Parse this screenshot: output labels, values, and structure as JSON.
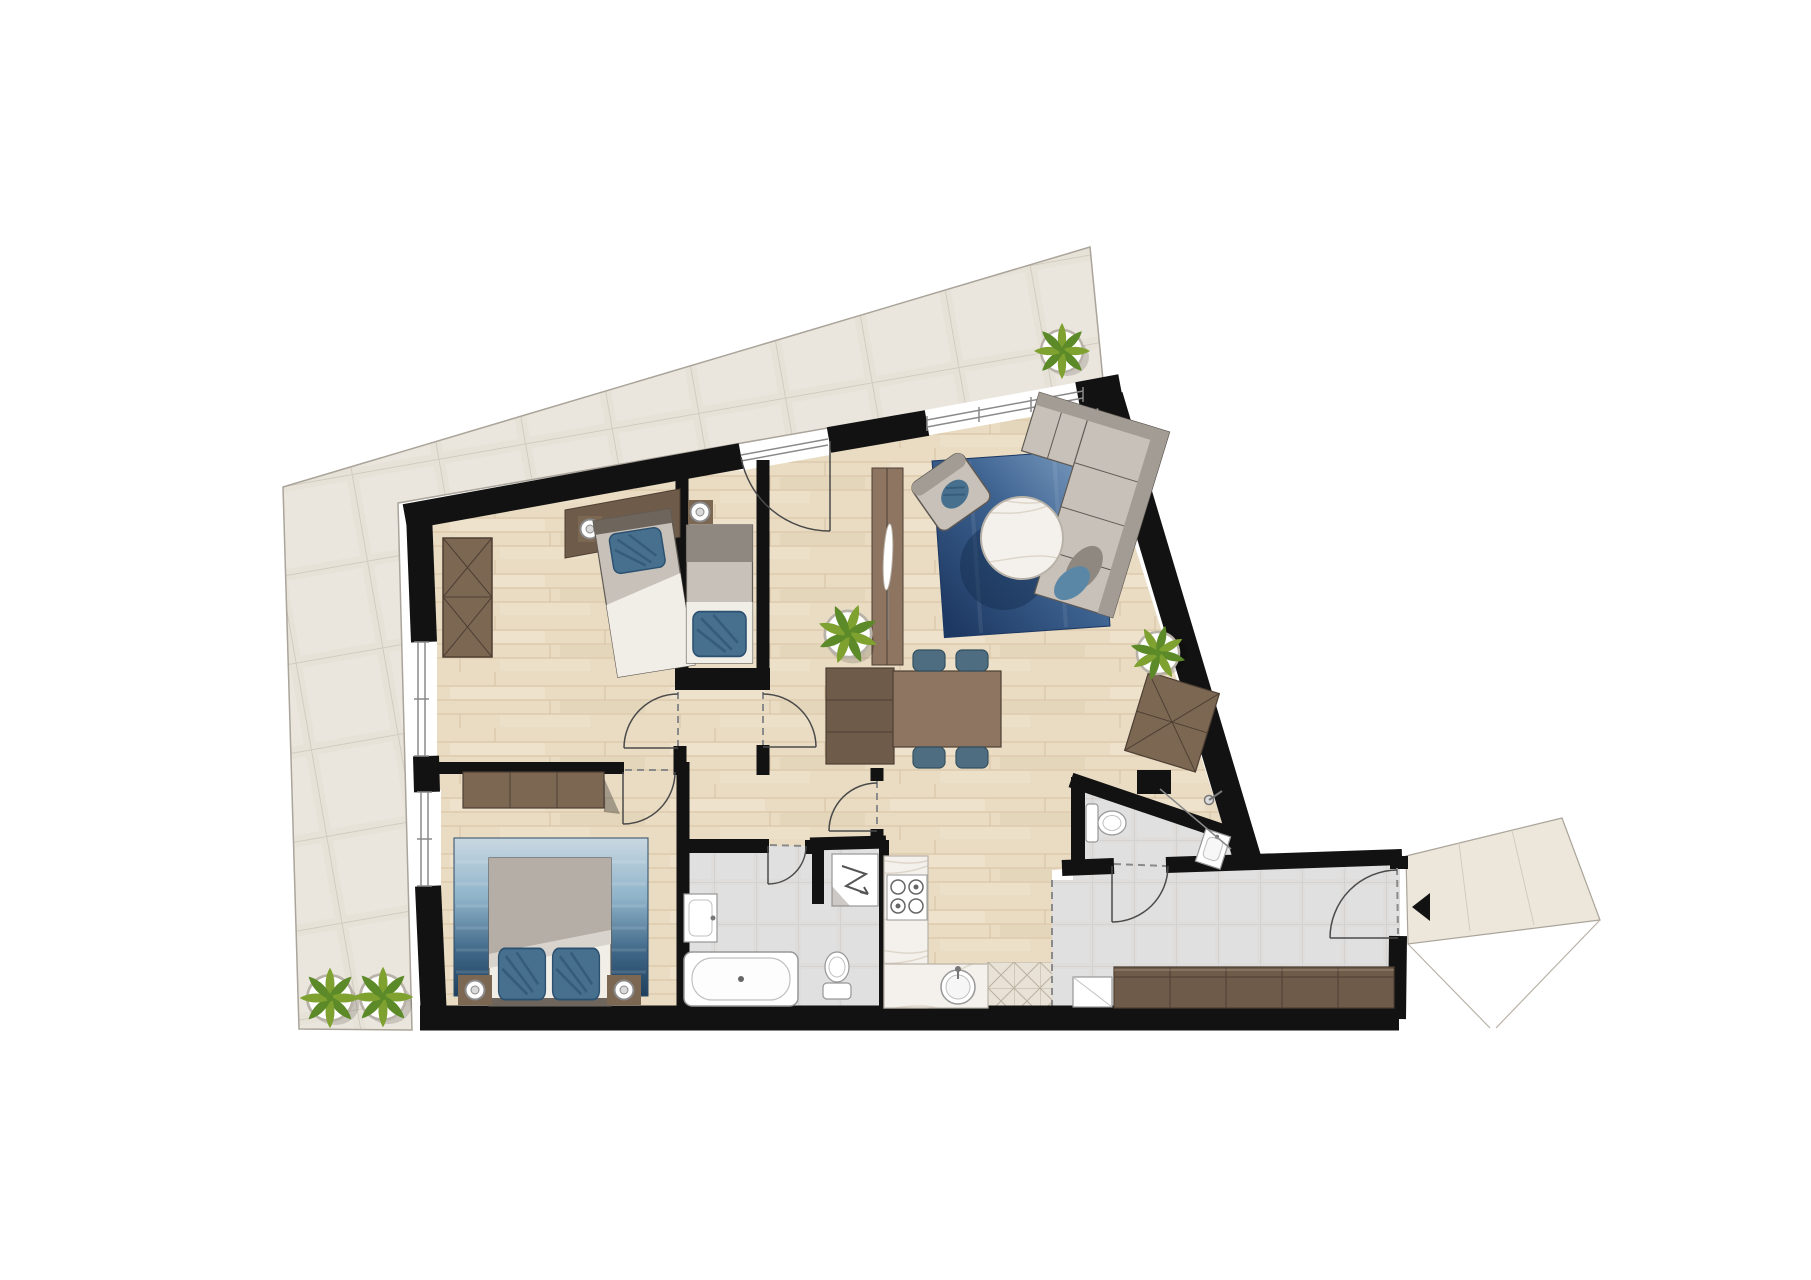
{
  "image": {
    "kind": "architectural floor plan, top-down color render of an apartment with terrace",
    "text_labels": []
  },
  "colors": {
    "background": "#ffffff",
    "wall": "#121212",
    "wood_floor": "#e9dcc3",
    "wood_floor_line": "#d6c2a2",
    "wood_streak_light": "#f2e7d2",
    "wood_streak_dark": "#dfcfb2",
    "terrace_tile": "#e7e2d8",
    "terrace_line": "#d2ccbf",
    "terrace_edge": "#aaa49a",
    "tile_floor": "#dedddc",
    "tile_line": "#cac9c8",
    "patterned_tile": "#e8e2d6",
    "patterned_tile_line": "#b9b0a0",
    "marble": "#f4f1ec",
    "marble_vein": "#d8cfc2",
    "walnut_dark": "#6f5b49",
    "walnut": "#7c6753",
    "walnut_light": "#8d7561",
    "walnut_line": "#4e3f33",
    "walnut_highlight": "#9b8673",
    "gray_furniture": "#c7c1b9",
    "gray_furniture_dark": "#a39c94",
    "gray_band": "#8e8880",
    "furniture_outline": "#5f5a54",
    "sheet_white": "#f1ede7",
    "blanket_gray": "#b5aea6",
    "blanket_fold": "#d8d3cc",
    "bed_head": "#6e655c",
    "white_fixture": "#ffffff",
    "fixture_outline": "#979797",
    "fixture_inner": "#c0c0c0",
    "rug_pale": "#c9d8e2",
    "rug_steel": "#8fb3c9",
    "rug_blue": "#3f6787",
    "rug_navy": "#203f5e",
    "living_rug_dark": "#1d3862",
    "living_rug_mid": "#3e6391",
    "living_rug_light": "#7b9cc0",
    "rug_shadow": "#152c4e",
    "pillow_blue": "#47708f",
    "pillow_streak": "#2c5170",
    "sofa_pillow_blue": "#5b87a6",
    "chair_blue": "#4f6d80",
    "chair_blue_dark": "#33505f",
    "plant_green": "#7ea12f",
    "plant_green_dark": "#5c8a28",
    "pot_rim": "#b9b2a8",
    "door_arc": "#4a4a4a",
    "opening_dash": "#8a8a8a",
    "glass_line": "#8a8a8a",
    "shadow": "#000000"
  },
  "rooms": [
    {
      "id": "terrace",
      "floor": "large beige stone tiles, wraps left and top of apartment"
    },
    {
      "id": "bedroom-1",
      "floor": "light wood",
      "position": "top-left"
    },
    {
      "id": "bedroom-2",
      "floor": "light wood",
      "position": "top-center, narrow"
    },
    {
      "id": "bedroom-3",
      "floor": "light wood",
      "position": "bottom-left"
    },
    {
      "id": "corridor",
      "floor": "light wood",
      "position": "center"
    },
    {
      "id": "living-dining",
      "floor": "light wood",
      "position": "right"
    },
    {
      "id": "kitchen",
      "floor": "light wood + patterned tile strip",
      "position": "bottom-center"
    },
    {
      "id": "bathroom",
      "floor": "gray tile",
      "position": "bottom-center-left"
    },
    {
      "id": "wc",
      "floor": "gray tile",
      "position": "bottom-right"
    },
    {
      "id": "entrance-hall",
      "floor": "gray tile",
      "position": "bottom-right"
    },
    {
      "id": "landing",
      "floor": "beige tile, outside entrance door",
      "position": "far bottom-right"
    }
  ],
  "furniture": [
    {
      "room": "bedroom-1",
      "items": [
        "wardrobe with X front",
        "desk along top wall",
        "nightstand with lamp",
        "single bed with blue pillow"
      ]
    },
    {
      "room": "bedroom-2",
      "items": [
        "nightstand with lamp",
        "single bed with blue pillow at foot"
      ]
    },
    {
      "room": "bedroom-3",
      "items": [
        "dresser",
        "blue gradient rug",
        "double bed with two blue pillows",
        "two nightstands with lamps"
      ]
    },
    {
      "room": "living-dining",
      "items": [
        "corner sofa with chaise and two pillows",
        "round marble coffee table",
        "armchair with blue cushion",
        "blue rug",
        "tall divider cabinet with decor",
        "sideboard",
        "dining table",
        "four blue chairs",
        "chest with X front"
      ]
    },
    {
      "room": "kitchen",
      "items": [
        "L-shaped marble counter",
        "4-burner cooktop",
        "round sink"
      ]
    },
    {
      "room": "bathroom",
      "items": [
        "wash basin",
        "washing machine",
        "bathtub",
        "toilet"
      ]
    },
    {
      "room": "wc",
      "items": [
        "toilet",
        "small wash basin",
        "shower with glass screen"
      ]
    },
    {
      "room": "entrance-hall",
      "items": [
        "long dark wardrobe",
        "white cabinet"
      ]
    }
  ],
  "plants": {
    "count": 5,
    "locations": [
      "terrace top-right",
      "terrace bottom-left (two)",
      "corridor near bedroom-2",
      "living room near right wall"
    ]
  },
  "openings": {
    "windows": [
      "bedroom-1 left wall",
      "bedroom-3 left wall",
      "living room top wall (large glazing)",
      "terrace glass door at corridor"
    ],
    "doors": [
      "bedroom-1",
      "bedroom-2",
      "bedroom-3",
      "bathroom",
      "kitchen/hall",
      "wc",
      "entrance door with swing arc"
    ],
    "entrance_marker": "black triangle arrow at entrance door"
  }
}
